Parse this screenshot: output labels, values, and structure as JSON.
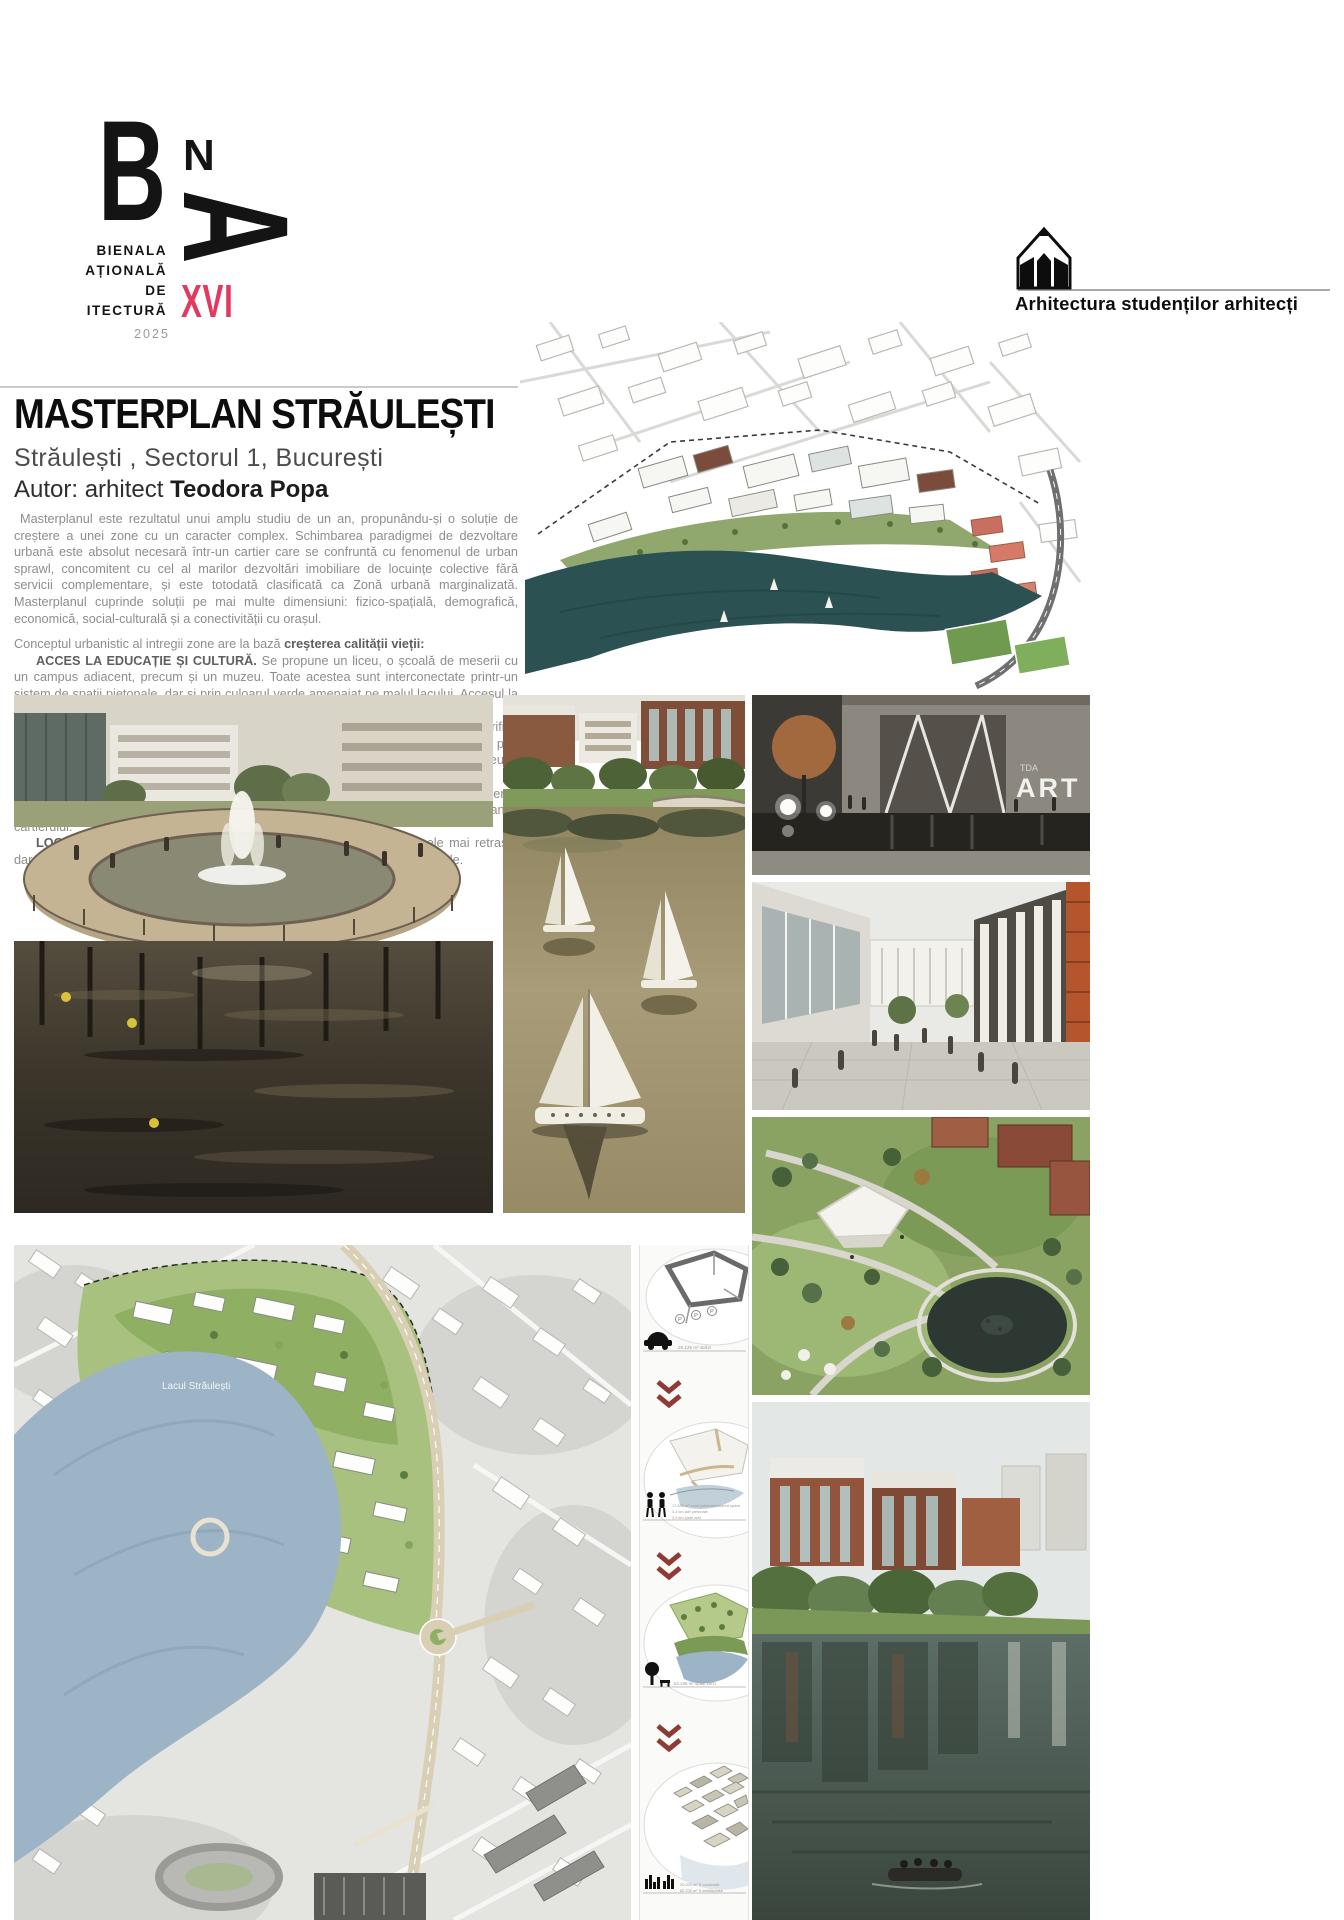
{
  "header": {
    "logo": {
      "letter_b": "B",
      "letter_n": "N",
      "letter_a": "A",
      "line1": "BIENALA",
      "line2": "NAȚIONALĂ",
      "line3": "DE",
      "line4": "ARHITECTURĂ",
      "edition": "XVI",
      "year": "2025",
      "edition_color": "#e23a5e"
    },
    "program": {
      "icon": "pencil-house-icon",
      "label": "Arhitectura studenților arhitecți"
    }
  },
  "title_block": {
    "title": "MASTERPLAN STRĂULEȘTI",
    "subtitle": "Străulești , Sectorul 1, București",
    "author_prefix": "Autor: arhitect ",
    "author_name": "Teodora Popa"
  },
  "article": {
    "intro": "Masterplanul este rezultatul unui amplu studiu de un an, propunându-și o soluție de creștere a unei zone cu un caracter complex. Schimbarea paradigmei de dezvoltare urbană este absolut necesară într-un cartier care se confruntă cu fenomenul de urban sprawl, concomitent cu cel al marilor dezvoltări imobiliare de locuințe colective fără servicii complementare, și este totodată clasificată ca Zonă urbană marginalizată. Masterplanul cuprinde soluții pe mai multe dimensiuni: fizico-spațială, demografică, economică, social-culturală și a conectivității cu orașul.",
    "concept_lead": "Conceptul urbanistic al intregii zone are la bază ",
    "concept_bold": "creșterea calității vieții:",
    "sections": [
      {
        "lead": "ACCES LA EDUCAȚIE ȘI CULTURĂ.",
        "text": " Se propune un liceu, o școală de meserii cu un campus adiacent, precum și un muzeu. Toate acestea sunt interconectate printr-un sistem de spații pietonale, dar și prin culoarul verde amenajat pe malul lacului. Accesul la educație este esențial pentru sectorul de populație din zonele marginalizate."
      },
      {
        "lead": "CALITATEA SPAȚIULUI PUBLIC.",
        "text": " Propunerea urmărește să identifice și valorifice elementele dominante in favoarea societății: accesul la apă este redat publicului larg, prin exproprieri și amenajarea culoarului verde. Spațiile verzi sunt interconectate, și împreună cu circulațiile pietonale extinse cresc semnificativ accesibilitatea pietonală/velo."
      },
      {
        "lead": "DEZVOLTAREA ECONOMICĂ.",
        "text": " Sunt propuse suprafețe mari de servicii, cu diverse funcțiuni, care pot susține locuri de muncă pe plan local, precum și creșterea siguranței cartierului."
      },
      {
        "lead": "LOCUIRE DE CALITATE.",
        "text": " Locuințele colective propuse sunt în zonele mai retrase, dar cu accesibilitate bună la servicii, transport in comun, spații verzi și pietonale."
      }
    ]
  },
  "images": {
    "art_plaza": {
      "small_label": "TDA",
      "big_label": "ART"
    },
    "siteplan": {
      "lake_label": "Lacul Străulești"
    }
  },
  "diagrams": {
    "chevron_color": "#8e3a35",
    "items": [
      {
        "icon": "car-icon",
        "captions": [
          "25.126 m² străzi"
        ]
      },
      {
        "icon": "pedestrians-icon",
        "captions": [
          "17.646 m² zone pietonale/shared space",
          "3,4 km alei pietonale",
          "2,9 km piste velo"
        ]
      },
      {
        "icon": "tree-bench-icon",
        "captions": [
          "62.196 m² spații verzi"
        ]
      },
      {
        "icon": "skyline-icon",
        "captions": [
          "20.000 m² S construită",
          "82.200 m² S desfășurată"
        ]
      }
    ]
  }
}
